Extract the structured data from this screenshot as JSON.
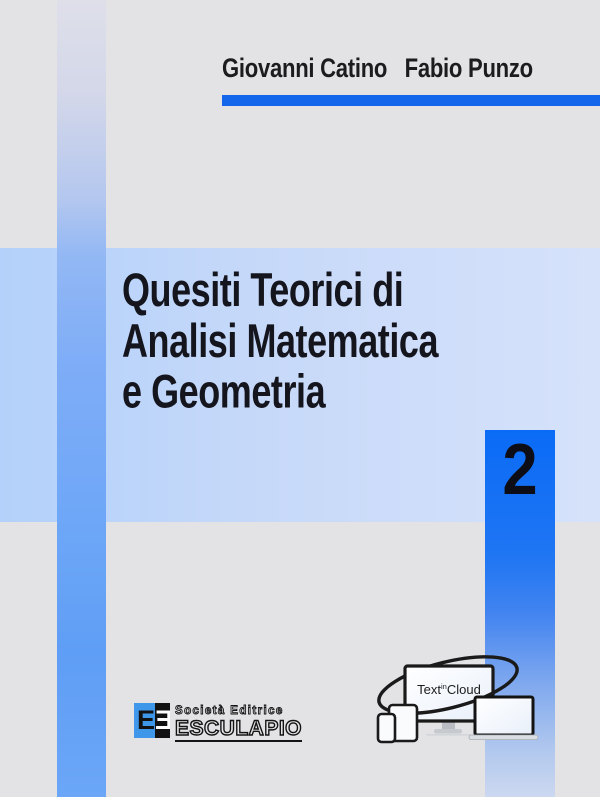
{
  "cover": {
    "authors": {
      "author1": "Giovanni Catino",
      "author2": "Fabio Punzo"
    },
    "title_lines": [
      "Quesiti Teorici di",
      "Analisi Matematica",
      "e Geometria"
    ],
    "volume_number": "2",
    "publisher": {
      "monogram_left": "E",
      "monogram_right": "Ǝ",
      "name_line1": "Società Editrice",
      "name_line2": "ESCULAPIO"
    },
    "brand": {
      "text_pre": "Text",
      "text_sup": "in",
      "text_post": "Cloud"
    },
    "colors": {
      "accent_blue": "#1467ea",
      "volume_box_blue": "#0a6bf6",
      "stripe_blue": "#5f9ef6",
      "band_blue": "#c7d9f9",
      "background_gray": "#e3e3e5",
      "title_ink": "#15151e",
      "esculapio_blue": "#3e97e8"
    }
  }
}
